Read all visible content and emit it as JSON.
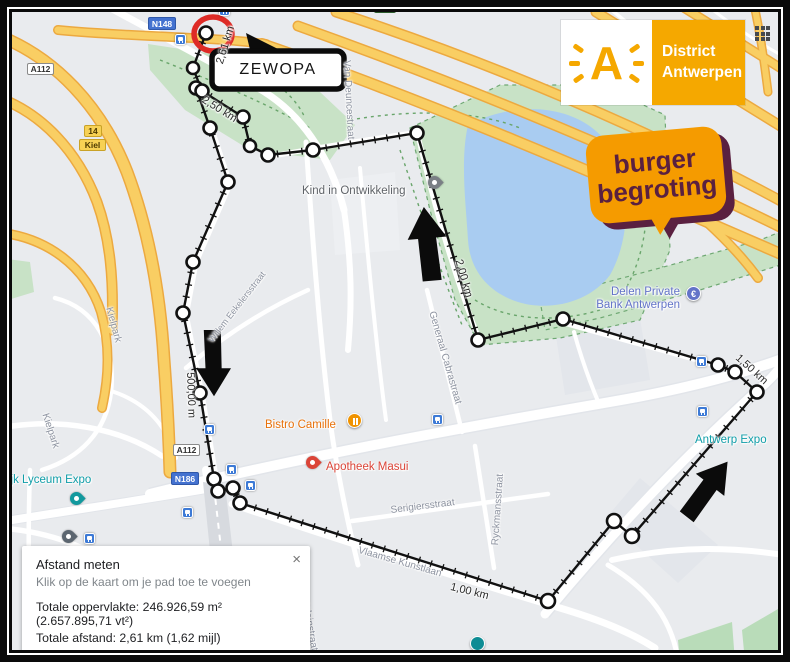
{
  "callout": {
    "label": "ZEWOPA"
  },
  "logos": {
    "district": {
      "letter": "A",
      "line1": "District",
      "line2": "Antwerpen"
    },
    "burger": {
      "line1": "burger",
      "line2": "begroting"
    }
  },
  "badges": {
    "n148": "N148",
    "a112_top": "A112",
    "a112_mid": "A112",
    "n186": "N186",
    "ring_num": "14",
    "ring_name": "Kiel"
  },
  "pois": {
    "kind": "Kind in Ontwikkeling",
    "bistro": "Bistro Camille",
    "apotheek": "Apotheek Masui",
    "delen_line1": "Delen Private",
    "delen_line2": "Bank Antwerpen",
    "expo": "Antwerp Expo",
    "lyceum": "ijk Lyceum Expo"
  },
  "streets": {
    "willem": "Willem Eekelersstraat",
    "vandeunce": "Van Deuncestraat",
    "cabra": "Generaal Cabrastraat",
    "ryckmans": "Ryckmansstraat",
    "serigiers": "Serigiersstraat",
    "vlaamse": "Vlaamse Kunstlaan",
    "castelein": "Casteleinstraat",
    "kielpark1": "Kielpark",
    "kielpark2": "Kielpark"
  },
  "measurements": {
    "d2610": "2,61 km",
    "d2500": "2,50 km",
    "d2000": "2,00 km",
    "d1500": "1,50 km",
    "d1000": "1,00 km",
    "d500": "500,00 m"
  },
  "panel": {
    "title": "Afstand meten",
    "subtitle": "Klik op de kaart om je pad toe te voegen",
    "area": "Totale oppervlakte: 246.926,59 m² (2.657.895,71 vt²)",
    "distance": "Totale afstand: 2,61 km (1,62 mijl)",
    "close": "×"
  },
  "colors": {
    "water": "#A9CCF1",
    "park": "#C8E2C6",
    "highway": "#F9CE63",
    "district_orange": "#F5A800",
    "burger_orange": "#F59B00",
    "burger_plum": "#5A2040",
    "route_black": "#111111",
    "red_circle": "#DE2B26",
    "transit_blue": "#3D7AD6"
  }
}
